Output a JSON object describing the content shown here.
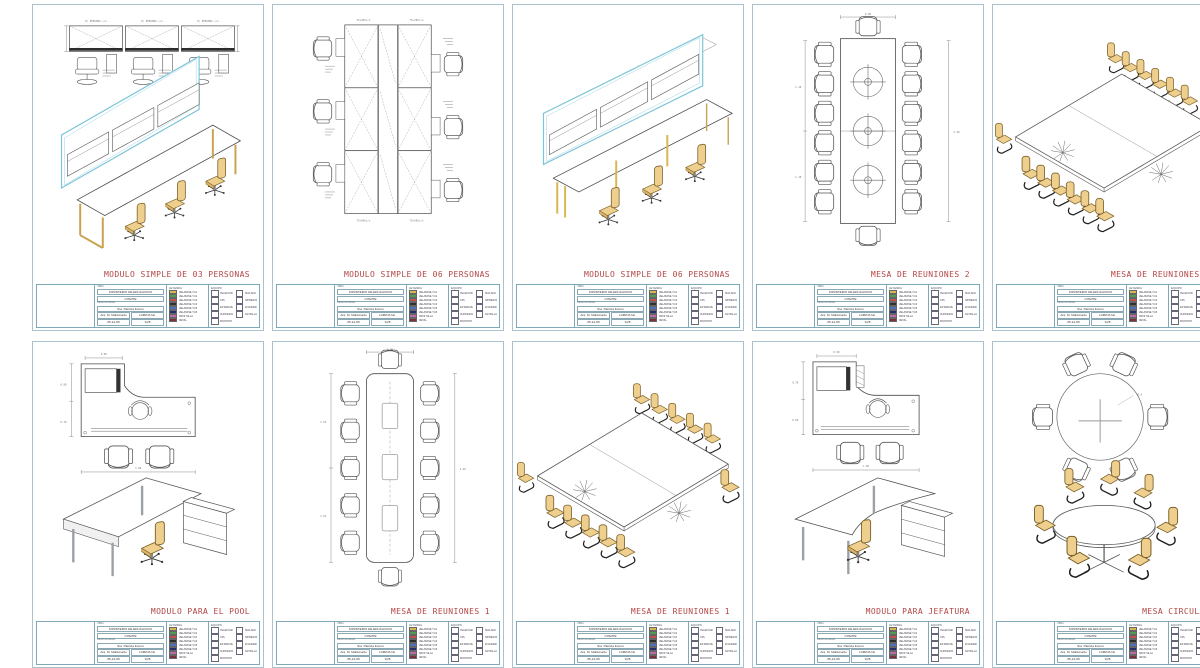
{
  "page": {
    "background": "#ffffff",
    "title_color": "#b34545",
    "sheet_border": "#a9c2cd"
  },
  "sheets": [
    {
      "title": "MODULO SIMPLE DE 03 PERSONAS",
      "labels": {
        "module": "P/ PERSONA c/u"
      }
    },
    {
      "title": "MODULO SIMPLE DE 06 PERSONAS",
      "labels": {
        "dim": "75+h95c/u",
        "dim2": "75+h95c/u"
      }
    },
    {
      "title": "MODULO SIMPLE DE 06 PERSONAS",
      "labels": {}
    },
    {
      "title": "MESA DE REUNIONES 2",
      "labels": {
        "top": "0.90",
        "left1": "1.10",
        "left2": "1.10",
        "right": "2.40"
      }
    },
    {
      "title": "MESA DE REUNIONES 2",
      "labels": {}
    },
    {
      "title": "MODULO PARA EL POOL",
      "labels": {
        "top": "0.60",
        "left1": "0.80",
        "left2": "0.70",
        "bottom": "1.80"
      }
    },
    {
      "title": "MESA DE REUNIONES 1",
      "labels": {
        "top": "0.90",
        "left1": "1.10",
        "left2": "1.10",
        "right": "2.40"
      }
    },
    {
      "title": "MESA DE REUNIONES 1",
      "labels": {}
    },
    {
      "title": "MODULO PARA JEFATURA",
      "labels": {
        "top": "0.90",
        "left1": "0.78",
        "left2": "0.60",
        "bottom": "1.66"
      }
    },
    {
      "title": "MESA CIRCULAR",
      "labels": {
        "note": "R.A"
      }
    }
  ],
  "title_block": {
    "obra_label": "OBRA:",
    "obra": "MINISTERIO DE EDUCACION",
    "cliente_label": "CLIENTE:",
    "cliente": "COMITE",
    "responsable_label": "RESPONSABLE:",
    "responsable": "Sra. Patricia Forero",
    "dibujo": "Arq. M. Maldonado",
    "lamina_label": "LAMINA No.",
    "fecha": "05-12-05",
    "escala": "1/25",
    "legend_title": "LEYENDA",
    "legend": [
      {
        "color": "#d8b84e",
        "label": "MELAMINE T-01"
      },
      {
        "color": "#4f9e4f",
        "label": "MELAMINE T-02"
      },
      {
        "color": "#c0504d",
        "label": "MELAMINE T-03"
      },
      {
        "color": "#303030",
        "label": "MELAMINE T-04"
      },
      {
        "color": "#4f6fc0",
        "label": "MELAMINE T-05"
      },
      {
        "color": "#24306e",
        "label": "MELAMINE T-06"
      },
      {
        "color": "#c06aa6",
        "label": "TAPIZ SILLA"
      },
      {
        "color": "#7e3040",
        "label": "METAL"
      }
    ],
    "symbols_title": "EQUIPO",
    "symbols": [
      {
        "label": "TELEFONO"
      },
      {
        "label": "CPU"
      },
      {
        "label": "ESTABILIZADOR"
      },
      {
        "label": "SUPRESOR"
      },
      {
        "label": "MONITOR"
      },
      {
        "label": "TECLADO"
      },
      {
        "label": "IMPRESORA"
      },
      {
        "label": "SCANNER"
      },
      {
        "label": "PANTALLA"
      }
    ]
  }
}
